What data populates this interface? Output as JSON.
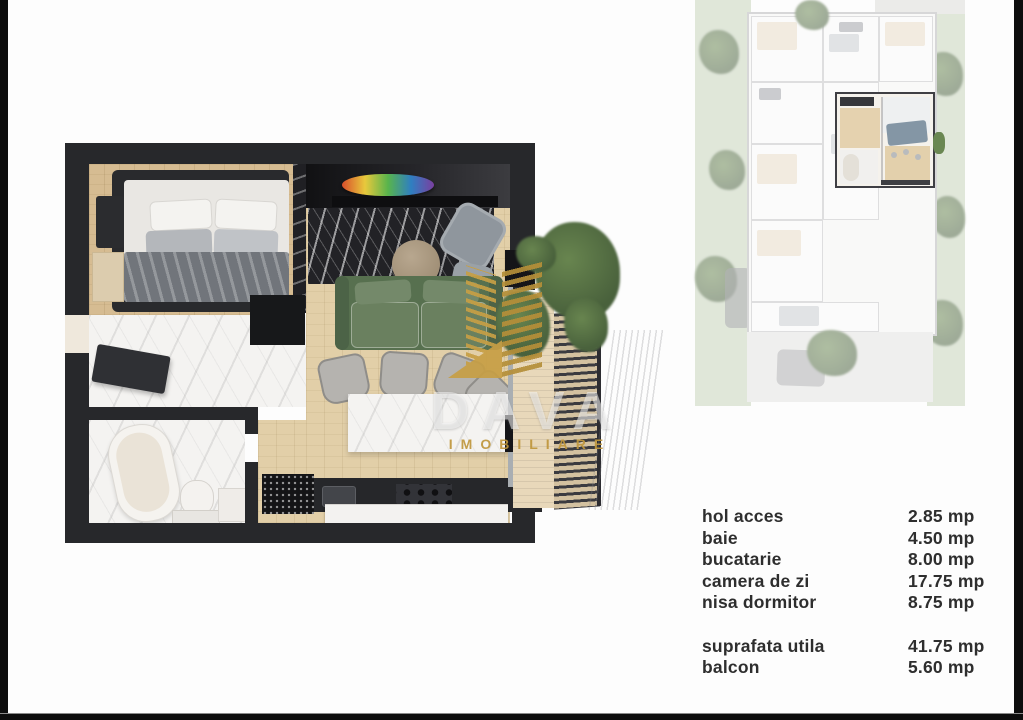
{
  "watermark": {
    "title": "DAVA",
    "subtitle": "IMOBILIARE",
    "gold": "#c49a3e"
  },
  "legend": {
    "rooms": [
      {
        "label": "hol acces",
        "value": "2.85 mp"
      },
      {
        "label": "baie",
        "value": "4.50 mp"
      },
      {
        "label": "bucatarie",
        "value": "8.00 mp"
      },
      {
        "label": "camera de zi",
        "value": "17.75 mp"
      },
      {
        "label": "nisa dormitor",
        "value": "8.75 mp"
      }
    ],
    "totals": [
      {
        "label": "suprafata utila",
        "value": "41.75 mp"
      },
      {
        "label": "balcon",
        "value": "5.60 mp"
      }
    ]
  },
  "palette": {
    "frame_bar": "#0d0d0d",
    "wall": "#27282b",
    "wood_floor": "#e2cfa8",
    "bedroom_floor": "#d6bc92",
    "marble_light": "#f4f3f1",
    "marble_dark": "#222226",
    "sofa_green": "#5a7053",
    "balcony_wood": "#e8d8ba",
    "plant_green": "#55703f",
    "grass": "#c6d3ba",
    "legend_text": "#2e2e2e"
  }
}
